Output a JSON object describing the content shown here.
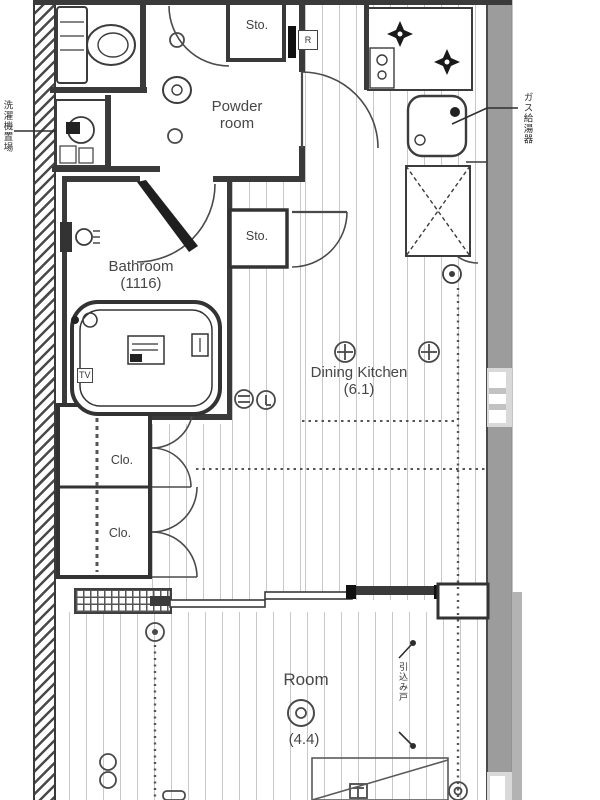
{
  "plan": {
    "rooms": {
      "powder_room": {
        "name_line1": "Powder",
        "name_line2": "room"
      },
      "bathroom": {
        "name": "Bathroom",
        "size": "(1116)"
      },
      "dining_kitchen": {
        "name": "Dining Kitchen",
        "size": "(6.1)"
      },
      "room": {
        "name": "Room",
        "size": "(4.4)"
      },
      "closet_upper": {
        "name": "Clo."
      },
      "closet_lower": {
        "name": "Clo."
      },
      "storage_top": {
        "name": "Sto."
      },
      "storage_mid": {
        "name": "Sto."
      }
    },
    "fixture_labels": {
      "bathtub_tv": "TV",
      "duct_box": "R"
    },
    "annotations": {
      "washer_space": "洗濯機置場",
      "water_heater": "ガス給湯器",
      "sliding_partition": "引込み戸"
    },
    "colors": {
      "wall_line": "#3a3a3a",
      "exterior_wall_gray": "#9c9c9c",
      "window_gray": "#d9d9d9",
      "floor_stripe": "#c8c8c8",
      "label_text": "#454545"
    }
  }
}
